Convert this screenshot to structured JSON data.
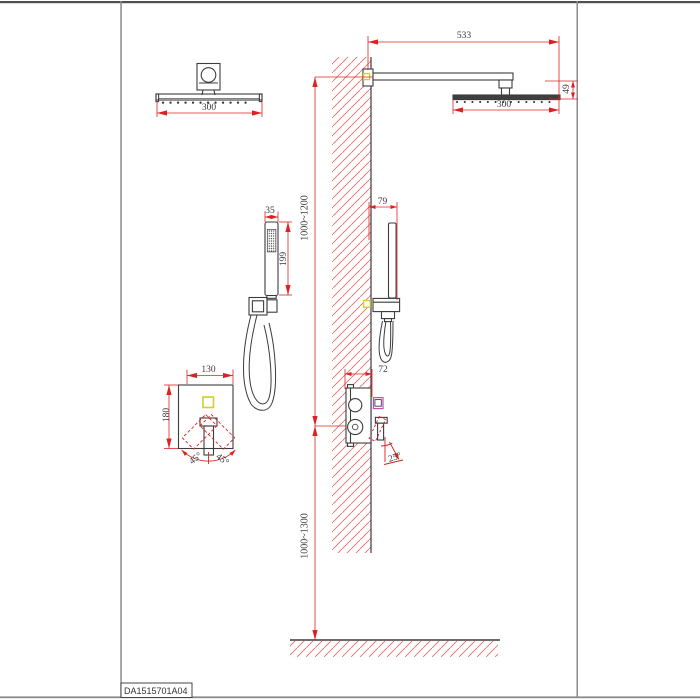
{
  "drawing_code": "DA1515701A04",
  "views": {
    "front_head": {
      "width": "300"
    },
    "front_hand_shower": {
      "width": "35",
      "length": "199"
    },
    "front_panel": {
      "width": "130",
      "height": "180",
      "swing_left": "45°",
      "swing_right": "45°"
    },
    "side": {
      "arm_length": "533",
      "head_width": "300",
      "head_drop": "49",
      "hand_shower_offset": "79",
      "valve_depth": "72",
      "handle_angle": "25°",
      "upper_height_range": "1000~1200",
      "lower_height_range": "1000~1300"
    }
  },
  "colors": {
    "dimension_red": "#e02020",
    "hatch_red": "#ec6a6a",
    "drawing_line": "#3c3c3c",
    "accent_yellow": "#cfcf2e",
    "accent_magenta": "#c24fc2"
  }
}
